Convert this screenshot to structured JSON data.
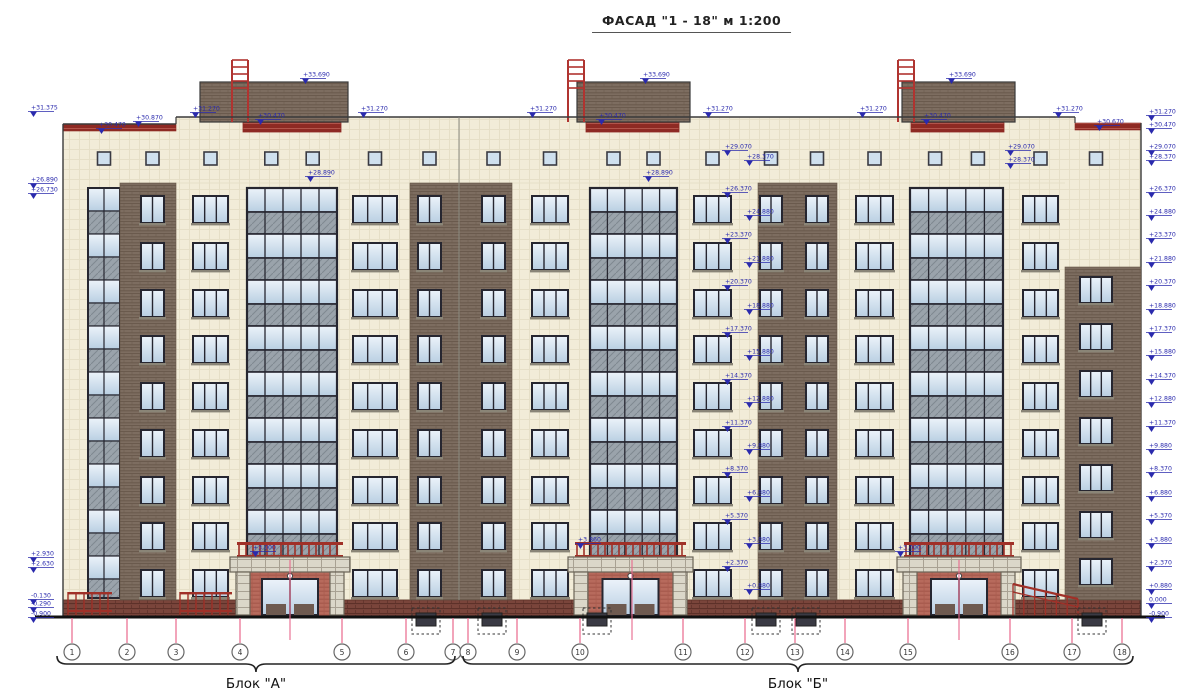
{
  "title": "ФАСАД \"1 - 18\"  м 1:200",
  "blocks": [
    {
      "label": "Блок \"А\"",
      "x1": 57,
      "x2": 455,
      "label_y": 683
    },
    {
      "label": "Блок \"Б\"",
      "x1": 463,
      "x2": 1133,
      "label_y": 683
    }
  ],
  "axes": {
    "y_line_top": 618,
    "y_line_bot": 643,
    "y_circle": 652,
    "radius": 8,
    "items": [
      {
        "label": "1",
        "x": 72
      },
      {
        "label": "2",
        "x": 127
      },
      {
        "label": "3",
        "x": 176
      },
      {
        "label": "4",
        "x": 240
      },
      {
        "label": "5",
        "x": 342
      },
      {
        "label": "6",
        "x": 406
      },
      {
        "label": "7",
        "x": 453
      },
      {
        "label": "8",
        "x": 468
      },
      {
        "label": "9",
        "x": 517
      },
      {
        "label": "10",
        "x": 580
      },
      {
        "label": "11",
        "x": 683
      },
      {
        "label": "12",
        "x": 745
      },
      {
        "label": "13",
        "x": 795
      },
      {
        "label": "14",
        "x": 845
      },
      {
        "label": "15",
        "x": 908
      },
      {
        "label": "16",
        "x": 1010
      },
      {
        "label": "17",
        "x": 1072
      },
      {
        "label": "18",
        "x": 1122
      }
    ],
    "extra_leaders": [
      290,
      632,
      959
    ]
  },
  "elevations": {
    "left": [
      [
        "+31.375",
        116
      ],
      [
        "+26.890",
        188
      ],
      [
        "+26.730",
        198
      ],
      [
        "+2.930",
        562
      ],
      [
        "+2.630",
        572
      ],
      [
        "-0.130",
        604
      ],
      [
        "-0.290",
        612
      ],
      [
        "-0.900",
        622
      ]
    ],
    "right": [
      [
        "+31.270",
        120
      ],
      [
        "+30.470",
        133
      ],
      [
        "+29.070",
        155
      ],
      [
        "+28.370",
        165
      ],
      [
        "+26.370",
        197
      ],
      [
        "+24.880",
        220
      ],
      [
        "+23.370",
        243
      ],
      [
        "+21.880",
        267
      ],
      [
        "+20.370",
        290
      ],
      [
        "+18.880",
        314
      ],
      [
        "+17.370",
        337
      ],
      [
        "+15.880",
        360
      ],
      [
        "+14.370",
        384
      ],
      [
        "+12.880",
        407
      ],
      [
        "+11.370",
        431
      ],
      [
        "+9.880",
        454
      ],
      [
        "+8.370",
        477
      ],
      [
        "+6.880",
        501
      ],
      [
        "+5.370",
        524
      ],
      [
        "+3.880",
        548
      ],
      [
        "+2.370",
        571
      ],
      [
        "+0.880",
        594
      ],
      [
        "0.000",
        608
      ],
      [
        "-0.900",
        622
      ]
    ],
    "center_column": {
      "x": 736,
      "values": [
        [
          "+29.070",
          155
        ],
        [
          "+28.370",
          165
        ],
        [
          "+26.370",
          197
        ],
        [
          "+24.880",
          220
        ],
        [
          "+23.370",
          243
        ],
        [
          "+21.880",
          267
        ],
        [
          "+20.370",
          290
        ],
        [
          "+18.880",
          314
        ],
        [
          "+17.370",
          337
        ],
        [
          "+15.880",
          360
        ],
        [
          "+14.370",
          384
        ],
        [
          "+12.880",
          407
        ],
        [
          "+11.370",
          431
        ],
        [
          "+9.880",
          454
        ],
        [
          "+8.370",
          477
        ],
        [
          "+6.880",
          501
        ],
        [
          "+5.370",
          524
        ],
        [
          "+3.880",
          548
        ],
        [
          "+2.370",
          571
        ],
        [
          "+0.880",
          594
        ]
      ]
    },
    "interior": [
      {
        "x": 300,
        "v": "+33.690",
        "y": 83
      },
      {
        "x": 640,
        "v": "+33.690",
        "y": 83
      },
      {
        "x": 946,
        "v": "+33.690",
        "y": 83
      },
      {
        "x": 190,
        "v": "+31.270",
        "y": 117
      },
      {
        "x": 358,
        "v": "+31.270",
        "y": 117
      },
      {
        "x": 527,
        "v": "+31.270",
        "y": 117
      },
      {
        "x": 703,
        "v": "+31.270",
        "y": 117
      },
      {
        "x": 857,
        "v": "+31.270",
        "y": 117
      },
      {
        "x": 1053,
        "v": "+31.270",
        "y": 117
      },
      {
        "x": 96,
        "v": "+30.470",
        "y": 133
      },
      {
        "x": 133,
        "v": "+30.870",
        "y": 126
      },
      {
        "x": 255,
        "v": "+30.470",
        "y": 124
      },
      {
        "x": 596,
        "v": "+30.470",
        "y": 124
      },
      {
        "x": 921,
        "v": "+30.470",
        "y": 124
      },
      {
        "x": 1094,
        "v": "+30.670",
        "y": 130
      },
      {
        "x": 305,
        "v": "+28.890",
        "y": 181
      },
      {
        "x": 643,
        "v": "+28.890",
        "y": 181
      },
      {
        "x": 1005,
        "v": "+29.070",
        "y": 155
      },
      {
        "x": 1005,
        "v": "+28.370",
        "y": 168
      },
      {
        "x": 250,
        "v": "+3.000",
        "y": 556
      },
      {
        "x": 575,
        "v": "+3.860",
        "y": 548
      },
      {
        "x": 895,
        "v": "+3.000",
        "y": 556
      }
    ]
  },
  "facade": {
    "left": 63,
    "right": 1141,
    "parapet_main_y": 117,
    "parapet_left_y": 124,
    "parapet_right_y": 123,
    "parapet_step_left_x": 176,
    "parapet_step_right_x": 1075,
    "attic_bottom_y": 183,
    "plinth_top_y": 600,
    "ground_y": 617,
    "window_rows": [
      196,
      243,
      290,
      336,
      383,
      430,
      477,
      523,
      570
    ],
    "window_h": 27,
    "attic_sq_y": 152,
    "attic_sq_size": 13,
    "expansion_joint_x": 459,
    "bays": [
      {
        "type": "stair",
        "x1": 88,
        "x2": 120
      },
      {
        "type": "brick",
        "x1": 120,
        "x2": 176,
        "windows": [
          [
            141,
            164
          ]
        ]
      },
      {
        "type": "cream",
        "x1": 176,
        "x2": 247,
        "windows": [
          [
            193,
            228
          ]
        ]
      },
      {
        "type": "glazed",
        "x1": 247,
        "x2": 337
      },
      {
        "type": "cream",
        "x1": 337,
        "x2": 410,
        "windows": [
          [
            353,
            397
          ]
        ]
      },
      {
        "type": "brick",
        "x1": 410,
        "x2": 512,
        "windows": [
          [
            418,
            441
          ],
          [
            482,
            505
          ]
        ]
      },
      {
        "type": "cream",
        "x1": 512,
        "x2": 590,
        "windows": [
          [
            532,
            568
          ]
        ]
      },
      {
        "type": "glazed",
        "x1": 590,
        "x2": 677
      },
      {
        "type": "cream",
        "x1": 677,
        "x2": 758,
        "windows": [
          [
            694,
            731
          ]
        ]
      },
      {
        "type": "brick",
        "x1": 758,
        "x2": 837,
        "windows": [
          [
            760,
            782
          ],
          [
            806,
            828
          ]
        ]
      },
      {
        "type": "cream",
        "x1": 837,
        "x2": 910,
        "windows": [
          [
            856,
            893
          ]
        ]
      },
      {
        "type": "glazed",
        "x1": 910,
        "x2": 1003
      },
      {
        "type": "cream",
        "x1": 1003,
        "x2": 1065,
        "windows": [
          [
            1023,
            1058
          ]
        ]
      },
      {
        "type": "endbay",
        "x1": 1065,
        "x2": 1141,
        "windows": [
          [
            1080,
            1112
          ]
        ],
        "rows": [
          277,
          324,
          371,
          418,
          465,
          512,
          559
        ],
        "brick_top": 267
      }
    ],
    "glazed_cfg": {
      "y0": 188,
      "modules": 8,
      "clear_h": 24,
      "grey_h": 22,
      "cols": 5
    },
    "stair_cfg": {
      "y0": 188,
      "y1": 598,
      "band_h": 23
    },
    "penthouses": [
      {
        "x1": 200,
        "x2": 348,
        "band_x1": 243,
        "band_x2": 341,
        "ladder_x": 232
      },
      {
        "x1": 577,
        "x2": 690,
        "band_x1": 586,
        "band_x2": 679,
        "ladder_x": 568
      },
      {
        "x1": 902,
        "x2": 1015,
        "band_x1": 911,
        "band_x2": 1004,
        "ladder_x": 898
      }
    ],
    "penthouse_top_y": 82,
    "penthouse_base_y": 122,
    "band_h": 10,
    "ladder_top_y": 60,
    "porches": [
      {
        "x1": 233,
        "x2": 347
      },
      {
        "x1": 571,
        "x2": 690
      },
      {
        "x1": 900,
        "x2": 1018
      }
    ],
    "ground_railings": [
      [
        68,
        112
      ],
      [
        180,
        232
      ]
    ],
    "ramp_railing": {
      "x1": 1013,
      "x2": 1078,
      "y1": 584,
      "y2": 599
    },
    "basement_windows": [
      412,
      478,
      583,
      752,
      792,
      1078
    ]
  },
  "colors": {
    "cream": "#f2ecd8",
    "cream_line": "#e6dfc7",
    "brick": "#7d6d60",
    "brick_line": "#665648",
    "plinth": "#7a453b",
    "plinth_line": "#5d3129",
    "coping": "#8e2a23",
    "coping_line": "#b2544a",
    "railing_red": "#a03028",
    "ladder_red": "#b03430",
    "porch_brick": "#b76a5c",
    "porch_brick_line": "#a05346",
    "stone": "#dbd7c9",
    "stone_line": "#a8a193",
    "frame": "#262630",
    "glass_hi": "#ecf3fa",
    "glass_lo": "#b9cfe2",
    "grey_panel": "#9aa3ab",
    "grey_panel_line": "#7f8890",
    "marker_blue": "#2a2aad",
    "axis_pink": "#e8688c",
    "outline": "#3a3a3a",
    "ground": "#111111",
    "sill": "#8a8577"
  }
}
